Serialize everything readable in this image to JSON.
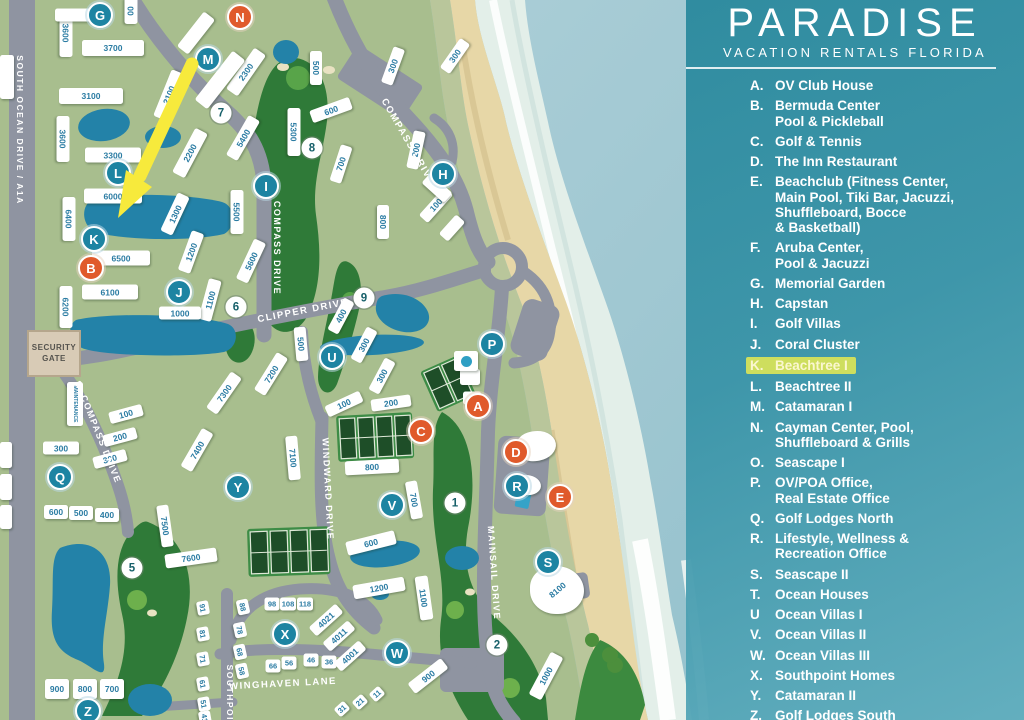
{
  "title": {
    "brand": "PARADISE",
    "tagline": "VACATION RENTALS FLORIDA"
  },
  "legend": {
    "items": [
      {
        "letter": "A.",
        "lines": [
          "OV Club House"
        ]
      },
      {
        "letter": "B.",
        "lines": [
          "Bermuda Center",
          "Pool & Pickleball"
        ]
      },
      {
        "letter": "C.",
        "lines": [
          "Golf & Tennis"
        ]
      },
      {
        "letter": "D.",
        "lines": [
          "The Inn Restaurant"
        ]
      },
      {
        "letter": "E.",
        "lines": [
          "Beachclub (Fitness Center,",
          "Main Pool, Tiki Bar, Jacuzzi,",
          "Shuffleboard, Bocce",
          "& Basketball)"
        ]
      },
      {
        "letter": "F.",
        "lines": [
          "Aruba Center,",
          "Pool & Jacuzzi"
        ]
      },
      {
        "letter": "G.",
        "lines": [
          "Memorial Garden"
        ]
      },
      {
        "letter": "H.",
        "lines": [
          "Capstan"
        ]
      },
      {
        "letter": "I.",
        "lines": [
          "Golf Villas"
        ]
      },
      {
        "letter": "J.",
        "lines": [
          "Coral Cluster"
        ]
      },
      {
        "letter": "K.",
        "lines": [
          "Beachtree I"
        ],
        "highlight": true
      },
      {
        "letter": "L.",
        "lines": [
          "Beachtree II"
        ]
      },
      {
        "letter": "M.",
        "lines": [
          "Catamaran I"
        ]
      },
      {
        "letter": "N.",
        "lines": [
          "Cayman Center, Pool,",
          "Shuffleboard & Grills"
        ]
      },
      {
        "letter": "O.",
        "lines": [
          "Seascape I"
        ]
      },
      {
        "letter": "P.",
        "lines": [
          "OV/POA Office,",
          "Real Estate Office"
        ]
      },
      {
        "letter": "Q.",
        "lines": [
          "Golf Lodges North"
        ]
      },
      {
        "letter": "R.",
        "lines": [
          "Lifestyle, Wellness &",
          "Recreation Office"
        ]
      },
      {
        "letter": "S.",
        "lines": [
          "Seascape II"
        ]
      },
      {
        "letter": "T.",
        "lines": [
          "Ocean Houses"
        ]
      },
      {
        "letter": "U",
        "lines": [
          "Ocean Villas I"
        ]
      },
      {
        "letter": "V.",
        "lines": [
          "Ocean Villas II"
        ]
      },
      {
        "letter": "W.",
        "lines": [
          "Ocean Villas III"
        ]
      },
      {
        "letter": "X.",
        "lines": [
          "Southpoint Homes"
        ]
      },
      {
        "letter": "Y.",
        "lines": [
          "Catamaran II"
        ]
      },
      {
        "letter": "Z.",
        "lines": [
          "Golf Lodges South"
        ]
      }
    ]
  },
  "map": {
    "security_gate": "SECURITY GATE",
    "road_labels": [
      {
        "t": "SOUTH OCEAN DRIVE / A1A",
        "x": 20,
        "y": 130,
        "r": 90,
        "f": 8.5
      },
      {
        "t": "COMPASS DRIVE",
        "x": 408,
        "y": 142,
        "r": 60,
        "f": 9.5
      },
      {
        "t": "COMPASS DRIVE",
        "x": 277,
        "y": 248,
        "r": 90,
        "f": 9
      },
      {
        "t": "CLIPPER DRIVE",
        "x": 303,
        "y": 311,
        "r": -11,
        "f": 9.5
      },
      {
        "t": "S. COMPASS DRIVE",
        "x": 98,
        "y": 432,
        "r": 68,
        "f": 9
      },
      {
        "t": "WINDWARD DRIVE",
        "x": 328,
        "y": 489,
        "r": 87,
        "f": 9
      },
      {
        "t": "MAINSAIL DRIVE",
        "x": 494,
        "y": 573,
        "r": 86,
        "f": 9
      },
      {
        "t": "WINGHAVEN LANE",
        "x": 283,
        "y": 684,
        "r": -3,
        "f": 9.5
      },
      {
        "t": "SOUTHPOINT",
        "x": 230,
        "y": 700,
        "r": 90,
        "f": 8.5
      }
    ],
    "buildings": [
      {
        "t": "3600",
        "x": 66,
        "y": 33,
        "w": 48,
        "h": 13,
        "r": 90
      },
      {
        "t": "00",
        "x": 131,
        "y": 11,
        "w": 26,
        "h": 13,
        "r": 90
      },
      {
        "t": "3700",
        "x": 113,
        "y": 48,
        "w": 62,
        "h": 16,
        "r": 0
      },
      {
        "t": "3100",
        "x": 91,
        "y": 96,
        "w": 64,
        "h": 16,
        "r": 0
      },
      {
        "t": "3600",
        "x": 63,
        "y": 139,
        "w": 46,
        "h": 13,
        "r": 90
      },
      {
        "t": "3300",
        "x": 113,
        "y": 155,
        "w": 56,
        "h": 15,
        "r": 0
      },
      {
        "t": "6000",
        "x": 113,
        "y": 196,
        "w": 58,
        "h": 15,
        "r": 0
      },
      {
        "t": "6400",
        "x": 69,
        "y": 219,
        "w": 44,
        "h": 13,
        "r": 90
      },
      {
        "t": "6500",
        "x": 121,
        "y": 258,
        "w": 58,
        "h": 15,
        "r": 0
      },
      {
        "t": "6100",
        "x": 110,
        "y": 292,
        "w": 56,
        "h": 15,
        "r": 0
      },
      {
        "t": "6200",
        "x": 66,
        "y": 307,
        "w": 42,
        "h": 13,
        "r": 90
      },
      {
        "t": "2100",
        "x": 169,
        "y": 95,
        "w": 50,
        "h": 14,
        "r": -68
      },
      {
        "t": "2200",
        "x": 190,
        "y": 153,
        "w": 50,
        "h": 14,
        "r": -62
      },
      {
        "t": "2300",
        "x": 246,
        "y": 72,
        "w": 50,
        "h": 14,
        "r": -55
      },
      {
        "t": "5300",
        "x": 294,
        "y": 132,
        "w": 48,
        "h": 13,
        "r": 90
      },
      {
        "t": "5400",
        "x": 243,
        "y": 138,
        "w": 46,
        "h": 13,
        "r": -60
      },
      {
        "t": "5500",
        "x": 237,
        "y": 212,
        "w": 44,
        "h": 13,
        "r": 90
      },
      {
        "t": "5600",
        "x": 251,
        "y": 261,
        "w": 44,
        "h": 13,
        "r": -65
      },
      {
        "t": "500",
        "x": 316,
        "y": 68,
        "w": 34,
        "h": 12,
        "r": 90
      },
      {
        "t": "300",
        "x": 393,
        "y": 66,
        "w": 38,
        "h": 12,
        "r": -70
      },
      {
        "t": "300",
        "x": 455,
        "y": 56,
        "w": 36,
        "h": 12,
        "r": -55
      },
      {
        "t": "600",
        "x": 331,
        "y": 110,
        "w": 42,
        "h": 13,
        "r": -20
      },
      {
        "t": "700",
        "x": 341,
        "y": 164,
        "w": 38,
        "h": 12,
        "r": -72
      },
      {
        "t": "200",
        "x": 416,
        "y": 150,
        "w": 38,
        "h": 12,
        "r": -78
      },
      {
        "t": "100",
        "x": 436,
        "y": 205,
        "w": 38,
        "h": 12,
        "r": -48
      },
      {
        "t": "800",
        "x": 383,
        "y": 222,
        "w": 34,
        "h": 12,
        "r": 90
      },
      {
        "t": "1300",
        "x": 175,
        "y": 214,
        "w": 42,
        "h": 13,
        "r": -65
      },
      {
        "t": "1200",
        "x": 191,
        "y": 252,
        "w": 42,
        "h": 13,
        "r": -70
      },
      {
        "t": "1100",
        "x": 210,
        "y": 300,
        "w": 42,
        "h": 13,
        "r": -75
      },
      {
        "t": "1000",
        "x": 180,
        "y": 313,
        "w": 42,
        "h": 13,
        "r": 0
      },
      {
        "t": "400",
        "x": 341,
        "y": 316,
        "w": 36,
        "h": 12,
        "r": -62
      },
      {
        "t": "300",
        "x": 364,
        "y": 345,
        "w": 36,
        "h": 12,
        "r": -62
      },
      {
        "t": "300",
        "x": 382,
        "y": 376,
        "w": 36,
        "h": 12,
        "r": -62
      },
      {
        "t": "500",
        "x": 301,
        "y": 344,
        "w": 34,
        "h": 12,
        "r": 85
      },
      {
        "t": "100",
        "x": 344,
        "y": 404,
        "w": 38,
        "h": 12,
        "r": -25
      },
      {
        "t": "200",
        "x": 391,
        "y": 403,
        "w": 40,
        "h": 12,
        "r": -8
      },
      {
        "t": "800",
        "x": 372,
        "y": 467,
        "w": 54,
        "h": 14,
        "r": -3
      },
      {
        "t": "700",
        "x": 414,
        "y": 500,
        "w": 38,
        "h": 12,
        "r": 80
      },
      {
        "t": "7100",
        "x": 293,
        "y": 458,
        "w": 44,
        "h": 12,
        "r": 85
      },
      {
        "t": "7200",
        "x": 271,
        "y": 374,
        "w": 44,
        "h": 13,
        "r": -58
      },
      {
        "t": "7300",
        "x": 224,
        "y": 393,
        "w": 44,
        "h": 13,
        "r": -55
      },
      {
        "t": "7400",
        "x": 197,
        "y": 450,
        "w": 44,
        "h": 13,
        "r": -60
      },
      {
        "t": "7500",
        "x": 165,
        "y": 526,
        "w": 42,
        "h": 12,
        "r": 82
      },
      {
        "t": "7600",
        "x": 191,
        "y": 558,
        "w": 52,
        "h": 14,
        "r": -8
      },
      {
        "t": "100",
        "x": 126,
        "y": 414,
        "w": 34,
        "h": 12,
        "r": -15
      },
      {
        "t": "200",
        "x": 120,
        "y": 437,
        "w": 34,
        "h": 12,
        "r": -15
      },
      {
        "t": "300",
        "x": 110,
        "y": 459,
        "w": 34,
        "h": 12,
        "r": -15
      },
      {
        "t": "300",
        "x": 61,
        "y": 448,
        "w": 36,
        "h": 13,
        "r": 0
      },
      {
        "t": "600",
        "x": 56,
        "y": 512,
        "w": 24,
        "h": 14,
        "r": 0
      },
      {
        "t": "500",
        "x": 81,
        "y": 513,
        "w": 24,
        "h": 14,
        "r": 0
      },
      {
        "t": "400",
        "x": 107,
        "y": 515,
        "w": 24,
        "h": 14,
        "r": 0
      },
      {
        "t": "900",
        "x": 57,
        "y": 689,
        "w": 24,
        "h": 20,
        "r": 0
      },
      {
        "t": "800",
        "x": 85,
        "y": 689,
        "w": 24,
        "h": 20,
        "r": 0
      },
      {
        "t": "700",
        "x": 112,
        "y": 689,
        "w": 24,
        "h": 20,
        "r": 0
      },
      {
        "t": "600",
        "x": 371,
        "y": 543,
        "w": 50,
        "h": 14,
        "r": -14
      },
      {
        "t": "1200",
        "x": 379,
        "y": 588,
        "w": 52,
        "h": 14,
        "r": -10
      },
      {
        "t": "1100",
        "x": 424,
        "y": 598,
        "w": 44,
        "h": 13,
        "r": 82
      },
      {
        "t": "900",
        "x": 428,
        "y": 676,
        "w": 42,
        "h": 13,
        "r": -38
      },
      {
        "t": "1000",
        "x": 546,
        "y": 676,
        "w": 48,
        "h": 14,
        "r": -62
      },
      {
        "t": "98",
        "x": 272,
        "y": 604,
        "w": 15,
        "h": 13,
        "r": 0
      },
      {
        "t": "108",
        "x": 288,
        "y": 604,
        "w": 16,
        "h": 13,
        "r": 0
      },
      {
        "t": "118",
        "x": 305,
        "y": 604,
        "w": 16,
        "h": 13,
        "r": 0
      },
      {
        "t": "88",
        "x": 243,
        "y": 607,
        "w": 15,
        "h": 12,
        "r": 78
      },
      {
        "t": "78",
        "x": 240,
        "y": 630,
        "w": 15,
        "h": 12,
        "r": 78
      },
      {
        "t": "68",
        "x": 240,
        "y": 652,
        "w": 15,
        "h": 12,
        "r": 78
      },
      {
        "t": "58",
        "x": 242,
        "y": 671,
        "w": 15,
        "h": 12,
        "r": 78
      },
      {
        "t": "66",
        "x": 273,
        "y": 666,
        "w": 15,
        "h": 13,
        "r": 0
      },
      {
        "t": "56",
        "x": 289,
        "y": 663,
        "w": 15,
        "h": 13,
        "r": 0
      },
      {
        "t": "46",
        "x": 311,
        "y": 660,
        "w": 15,
        "h": 13,
        "r": 0
      },
      {
        "t": "36",
        "x": 329,
        "y": 662,
        "w": 15,
        "h": 13,
        "r": 0
      },
      {
        "t": "4021",
        "x": 326,
        "y": 620,
        "w": 36,
        "h": 12,
        "r": -42
      },
      {
        "t": "4011",
        "x": 339,
        "y": 636,
        "w": 34,
        "h": 12,
        "r": -42
      },
      {
        "t": "4001",
        "x": 350,
        "y": 656,
        "w": 34,
        "h": 12,
        "r": -42
      },
      {
        "t": "31",
        "x": 342,
        "y": 709,
        "w": 13,
        "h": 11,
        "r": -42
      },
      {
        "t": "21",
        "x": 360,
        "y": 702,
        "w": 13,
        "h": 11,
        "r": -42
      },
      {
        "t": "11",
        "x": 377,
        "y": 694,
        "w": 13,
        "h": 11,
        "r": -42
      },
      {
        "t": "91",
        "x": 203,
        "y": 608,
        "w": 14,
        "h": 12,
        "r": 80
      },
      {
        "t": "81",
        "x": 203,
        "y": 634,
        "w": 14,
        "h": 12,
        "r": 80
      },
      {
        "t": "71",
        "x": 203,
        "y": 659,
        "w": 14,
        "h": 12,
        "r": 80
      },
      {
        "t": "61",
        "x": 203,
        "y": 684,
        "w": 14,
        "h": 12,
        "r": 80
      },
      {
        "t": "51",
        "x": 204,
        "y": 704,
        "w": 14,
        "h": 12,
        "r": 80
      },
      {
        "t": "41",
        "x": 205,
        "y": 718,
        "w": 14,
        "h": 12,
        "r": 80
      },
      {
        "t": "8100",
        "x": 557,
        "y": 590,
        "w": 54,
        "h": 48,
        "r": 0,
        "lr": -40,
        "cls": "blob"
      },
      {
        "t": "MAINTENANCE",
        "x": 75,
        "y": 404,
        "w": 44,
        "h": 16,
        "r": 90,
        "f": 5
      },
      {
        "t": "",
        "x": 220,
        "y": 80,
        "w": 62,
        "h": 16,
        "r": -52
      },
      {
        "t": "",
        "x": 196,
        "y": 33,
        "w": 44,
        "h": 14,
        "r": -52
      },
      {
        "t": "",
        "x": 75,
        "y": 15,
        "w": 40,
        "h": 13,
        "r": 0
      },
      {
        "t": "",
        "x": 7,
        "y": 77,
        "w": 14,
        "h": 44,
        "r": 0
      },
      {
        "t": "",
        "x": 6,
        "y": 455,
        "w": 12,
        "h": 26,
        "r": 0
      },
      {
        "t": "",
        "x": 6,
        "y": 487,
        "w": 12,
        "h": 26,
        "r": 0
      },
      {
        "t": "",
        "x": 6,
        "y": 517,
        "w": 12,
        "h": 24,
        "r": 0
      },
      {
        "t": "",
        "x": 470,
        "y": 377,
        "w": 20,
        "h": 16,
        "r": 0
      },
      {
        "t": "",
        "x": 472,
        "y": 398,
        "w": 18,
        "h": 13,
        "r": 0
      },
      {
        "t": "",
        "x": 466,
        "y": 361,
        "w": 24,
        "h": 20,
        "r": 0,
        "cls": "dot"
      },
      {
        "t": "",
        "x": 536,
        "y": 446,
        "w": 40,
        "h": 30,
        "r": -10,
        "cls": "blob"
      },
      {
        "t": "",
        "x": 527,
        "y": 485,
        "w": 28,
        "h": 20,
        "r": 5,
        "cls": "blob"
      },
      {
        "t": "",
        "x": 452,
        "y": 228,
        "w": 26,
        "h": 12,
        "r": -48
      },
      {
        "t": "",
        "x": 437,
        "y": 188,
        "w": 30,
        "h": 13,
        "r": 42
      }
    ],
    "markers": [
      {
        "t": "G",
        "x": 100,
        "y": 15,
        "k": "t"
      },
      {
        "t": "N",
        "x": 240,
        "y": 17,
        "k": "o"
      },
      {
        "t": "M",
        "x": 208,
        "y": 59,
        "k": "t"
      },
      {
        "t": "7",
        "x": 221,
        "y": 113,
        "k": "h"
      },
      {
        "t": "8",
        "x": 312,
        "y": 148,
        "k": "h"
      },
      {
        "t": "I",
        "x": 266,
        "y": 186,
        "k": "t"
      },
      {
        "t": "H",
        "x": 443,
        "y": 174,
        "k": "t"
      },
      {
        "t": "L",
        "x": 118,
        "y": 173,
        "k": "t"
      },
      {
        "t": "K",
        "x": 94,
        "y": 239,
        "k": "t"
      },
      {
        "t": "B",
        "x": 91,
        "y": 268,
        "k": "o"
      },
      {
        "t": "J",
        "x": 179,
        "y": 292,
        "k": "t"
      },
      {
        "t": "6",
        "x": 236,
        "y": 307,
        "k": "h"
      },
      {
        "t": "9",
        "x": 364,
        "y": 298,
        "k": "h"
      },
      {
        "t": "U",
        "x": 332,
        "y": 357,
        "k": "t"
      },
      {
        "t": "P",
        "x": 492,
        "y": 344,
        "k": "t"
      },
      {
        "t": "A",
        "x": 478,
        "y": 406,
        "k": "o"
      },
      {
        "t": "C",
        "x": 421,
        "y": 431,
        "k": "o"
      },
      {
        "t": "D",
        "x": 516,
        "y": 452,
        "k": "o"
      },
      {
        "t": "R",
        "x": 517,
        "y": 486,
        "k": "t"
      },
      {
        "t": "E",
        "x": 560,
        "y": 497,
        "k": "o"
      },
      {
        "t": "1",
        "x": 455,
        "y": 503,
        "k": "h"
      },
      {
        "t": "Q",
        "x": 60,
        "y": 477,
        "k": "t"
      },
      {
        "t": "Y",
        "x": 238,
        "y": 487,
        "k": "t"
      },
      {
        "t": "V",
        "x": 392,
        "y": 505,
        "k": "t"
      },
      {
        "t": "S",
        "x": 548,
        "y": 562,
        "k": "t"
      },
      {
        "t": "5",
        "x": 132,
        "y": 568,
        "k": "h"
      },
      {
        "t": "X",
        "x": 285,
        "y": 634,
        "k": "t"
      },
      {
        "t": "W",
        "x": 397,
        "y": 653,
        "k": "t"
      },
      {
        "t": "2",
        "x": 497,
        "y": 645,
        "k": "h"
      },
      {
        "t": "Z",
        "x": 88,
        "y": 711,
        "k": "t"
      }
    ]
  },
  "colors": {
    "land": "#a8be8e",
    "water": "#2382a8",
    "road": "#8f94a1",
    "fairway": "#2f7a38",
    "teal_marker": "#1d84a2",
    "orange_marker": "#e05a2b",
    "highlight": "#cede5e",
    "sand": "#e7d7a7",
    "panel_teal": "#2c8a9e"
  }
}
